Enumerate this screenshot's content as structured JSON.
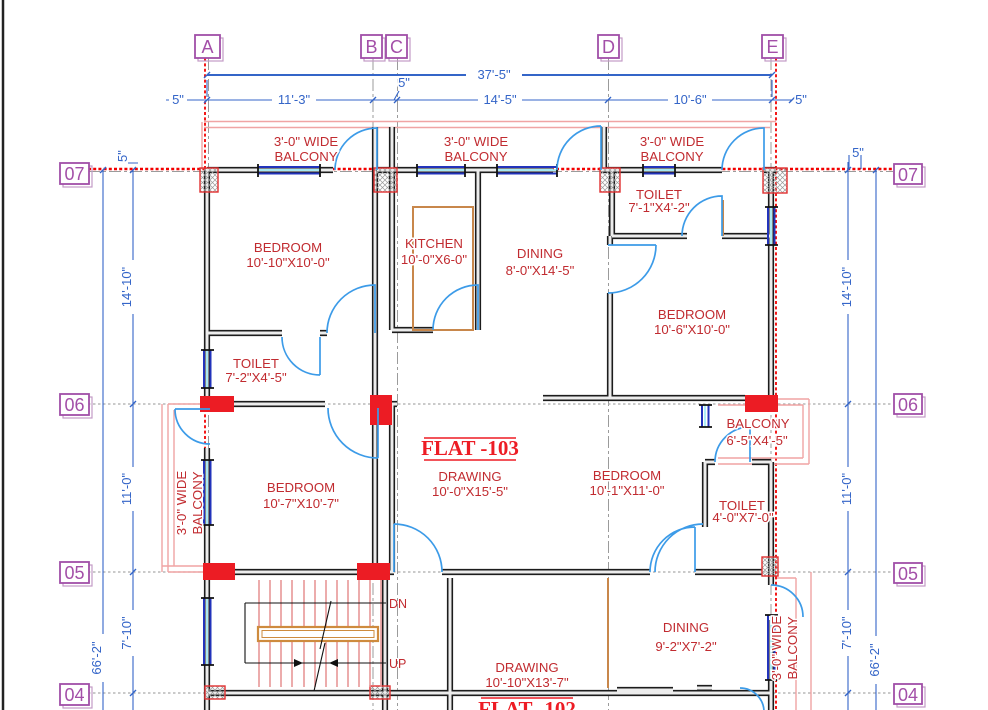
{
  "colors": {
    "label_red": "#C12B30",
    "flat_red": "#ED1C24",
    "dim_blue": "#3465C8",
    "grid_purple": "#A04FA8",
    "grid_line_red": "#F20000",
    "wall_black": "#1C1C1C",
    "balcony_pink": "#F0A4A4",
    "door_blue": "#3C9BE8",
    "window_blue": "#2233BB",
    "window_cyan": "#8FE8F2",
    "counter_tan": "#C8874B",
    "stair_tread": "#E59090",
    "handrail_orange": "#CE8B3E",
    "column_red": "#EC1C24"
  },
  "grid": {
    "columns": [
      "A",
      "B",
      "C",
      "D",
      "E"
    ],
    "rows": [
      "07",
      "06",
      "05",
      "04"
    ]
  },
  "dims": {
    "overall_width": "37'-5\"",
    "overall_height": "66'-2\"",
    "five_inch": "5\"",
    "w_11_3": "11'-3\"",
    "w_14_5": "14'-5\"",
    "w_10_6": "10'-6\"",
    "h_14_10": "14'-10\"",
    "h_11_0": "11'-0\"",
    "h_7_10": "7'-10\""
  },
  "flat_labels": {
    "flat_103": "FLAT -103",
    "flat_102": "FLAT -102"
  },
  "balcony_label": {
    "line1": "3'-0\" WIDE",
    "line2": "BALCONY"
  },
  "rooms": {
    "bedroom_top_left": {
      "name": "BEDROOM",
      "size": "10'-10\"X10'-0\""
    },
    "kitchen": {
      "name": "KITCHEN",
      "size": "10'-0\"X6-0\""
    },
    "dining_top": {
      "name": "DINING",
      "size": "8'-0\"X14'-5\""
    },
    "toilet_top_right": {
      "name": "TOILET",
      "size": "7'-1\"X4'-2\""
    },
    "bedroom_right": {
      "name": "BEDROOM",
      "size": "10'-6\"X10'-0\""
    },
    "toilet_left": {
      "name": "TOILET",
      "size": "7'-2\"X4'-5\""
    },
    "bedroom_mid_left": {
      "name": "BEDROOM",
      "size": "10'-7\"X10'-7\""
    },
    "drawing_103": {
      "name": "DRAWING",
      "size": "10'-0\"X15'-5\""
    },
    "bedroom_mid_right": {
      "name": "BEDROOM",
      "size": "10'-1\"X11'-0\""
    },
    "balcony_right": {
      "name": "BALCONY",
      "size": "6'-5\"X4'-5\""
    },
    "toilet_mid_right": {
      "name": "TOILET",
      "size": "4'-0\"X7'-0\""
    },
    "dining_bottom": {
      "name": "DINING",
      "size": "9'-2\"X7'-2\""
    },
    "drawing_102": {
      "name": "DRAWING",
      "size": "10'-10\"X13'-7\""
    }
  },
  "stairs": {
    "down": "DN",
    "up": "UP"
  }
}
